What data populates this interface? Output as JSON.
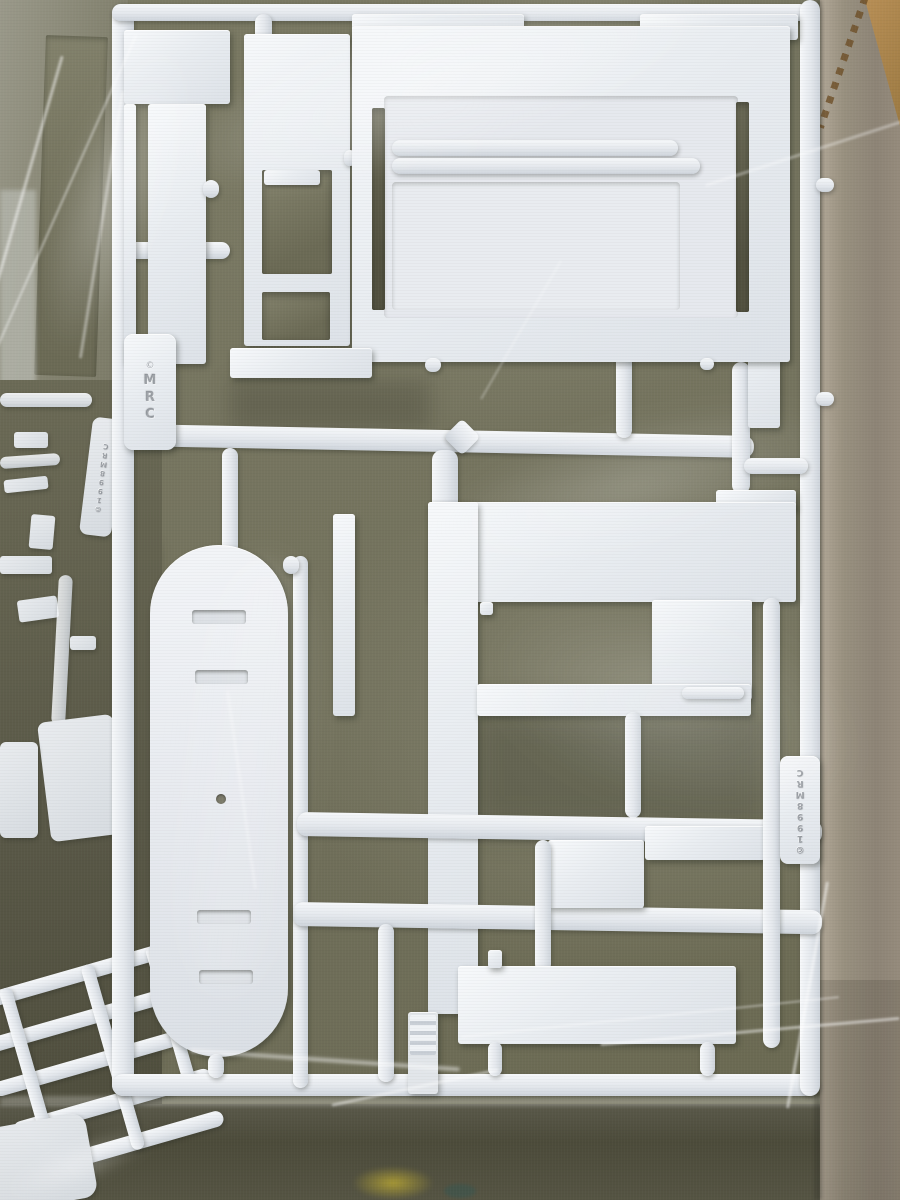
{
  "markings": {
    "brand": "MRC",
    "copyright_symbol": "©",
    "mold_stamp": "©1998MRC"
  },
  "colors": {
    "plastic_white": "#eef1f5",
    "plastic_shadow": "#cdd3da",
    "box_interior_olive": "#77765f",
    "box_interior_olive_dark": "#504f3d",
    "box_side_taupe": "#958c7d",
    "cardboard_tan": "#b68f57",
    "paint_spot_yellow": "#b2a134",
    "paint_spot_teal": "#3a564f"
  }
}
